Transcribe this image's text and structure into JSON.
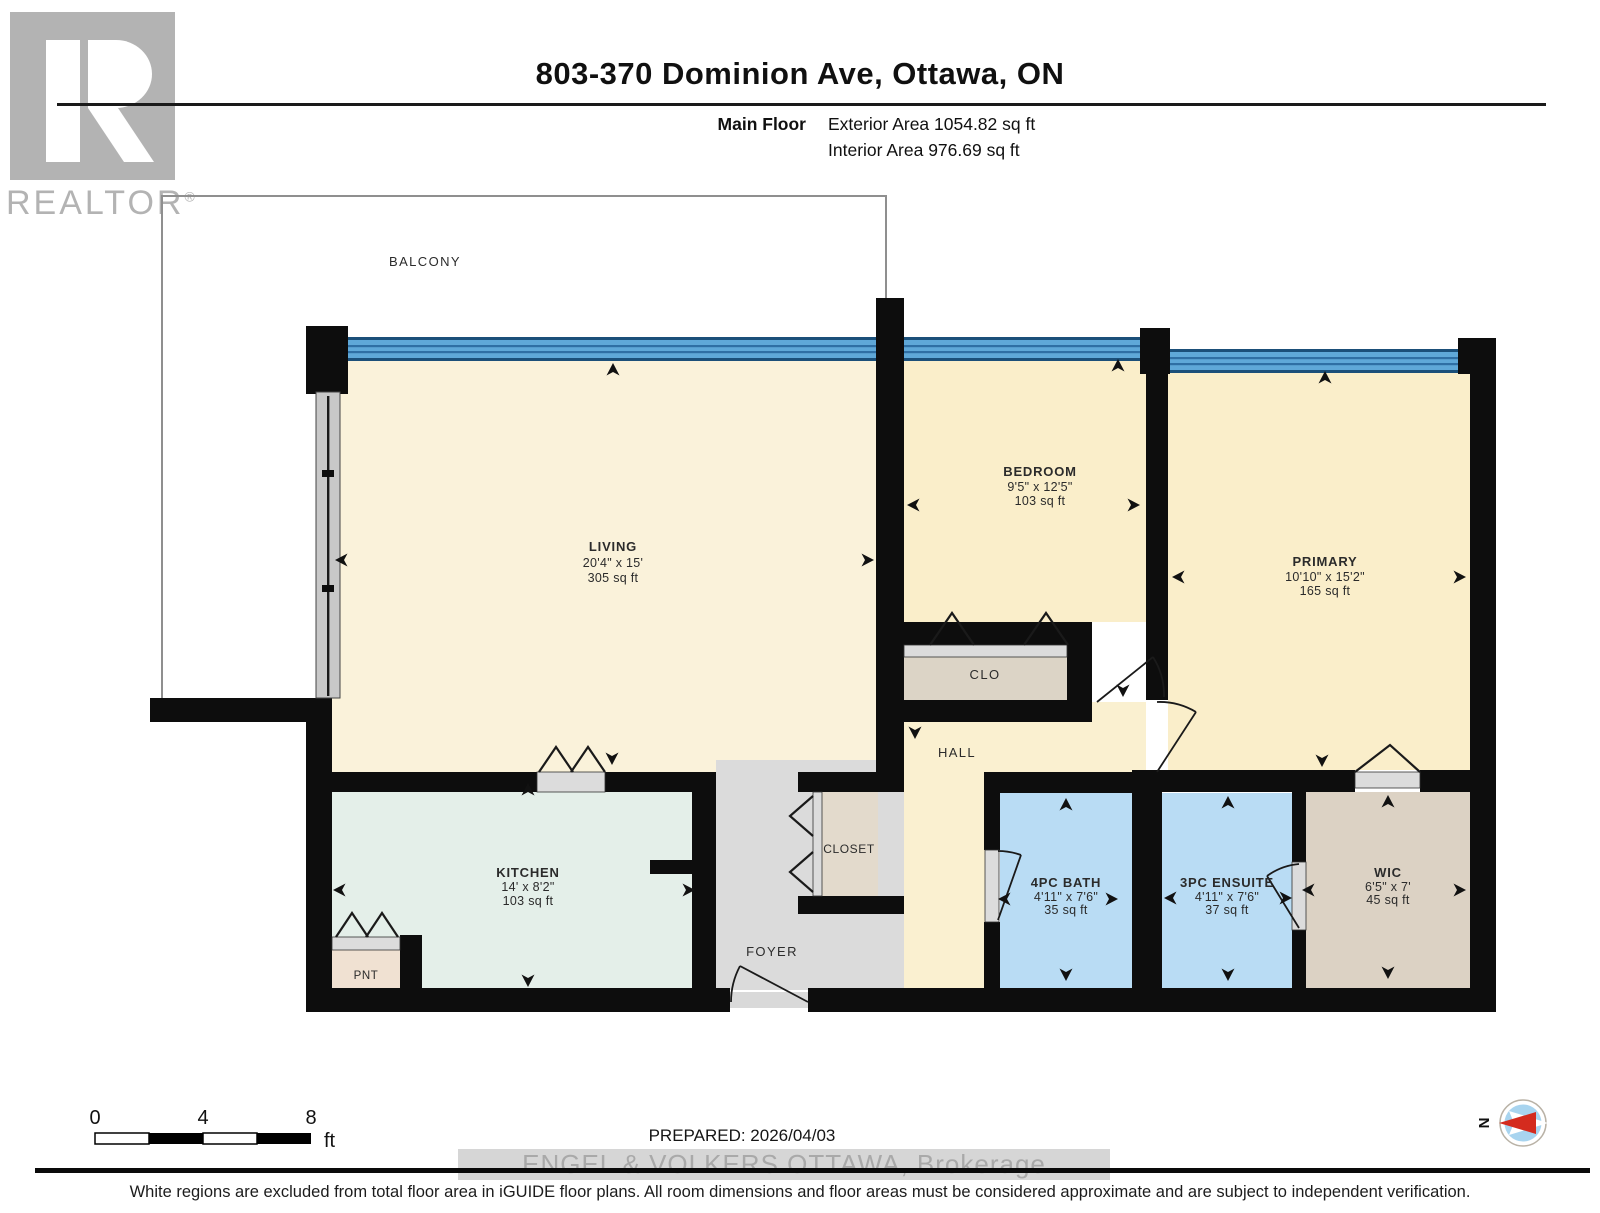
{
  "header": {
    "logo_letter": "R",
    "logo_word": "REALTOR",
    "logo_reg": "®",
    "title": "803-370 Dominion Ave, Ottawa, ON",
    "floor_label": "Main Floor",
    "exterior_area": "Exterior Area 1054.82 sq ft",
    "interior_area": "Interior Area 976.69 sq ft"
  },
  "rooms": {
    "balcony": {
      "name": "BALCONY"
    },
    "living": {
      "name": "LIVING",
      "dims": "20'4\" x 15'",
      "area": "305 sq ft"
    },
    "bedroom": {
      "name": "BEDROOM",
      "dims": "9'5\" x 12'5\"",
      "area": "103 sq ft"
    },
    "primary": {
      "name": "PRIMARY",
      "dims": "10'10\" x 15'2\"",
      "area": "165 sq ft"
    },
    "kitchen": {
      "name": "KITCHEN",
      "dims": "14' x 8'2\"",
      "area": "103 sq ft"
    },
    "bath": {
      "name": "4PC BATH",
      "dims": "4'11\" x 7'6\"",
      "area": "35 sq ft"
    },
    "ensuite": {
      "name": "3PC ENSUITE",
      "dims": "4'11\" x 7'6\"",
      "area": "37 sq ft"
    },
    "wic": {
      "name": "WIC",
      "dims": "6'5\" x 7'",
      "area": "45 sq ft"
    },
    "hall": {
      "name": "HALL"
    },
    "foyer": {
      "name": "FOYER"
    },
    "closet": {
      "name": "CLOSET"
    },
    "clo": {
      "name": "CLO"
    },
    "pnt": {
      "name": "PNT"
    }
  },
  "scale_bar": {
    "tick0": "0",
    "tick4": "4",
    "tick8": "8",
    "unit": "ft"
  },
  "compass": {
    "north": "N"
  },
  "footer": {
    "prepared": "PREPARED: 2026/04/03",
    "watermark": "ENGEL & VOLKERS OTTAWA, Brokerage",
    "disclaimer": "White regions are excluded from total floor area in iGUIDE floor plans. All room dimensions and floor areas must be considered approximate and are subject to independent verification."
  },
  "colors": {
    "wall": "#0d0d0d",
    "window_blue": "#5FA8D8",
    "living_cream": "#FAF2DA",
    "bedroom_cream": "#FAEECA",
    "hall_cream": "#FAF0D0",
    "kitchen_mint": "#E4EFE9",
    "bath_blue": "#B9DCF4",
    "closet_beige": "#DCD2C4",
    "pantry_beige": "#F0E1D2",
    "foyer_gray": "#DBDBDB",
    "compass_red": "#D42B1E",
    "logo_gray": "#b3b3b3"
  }
}
